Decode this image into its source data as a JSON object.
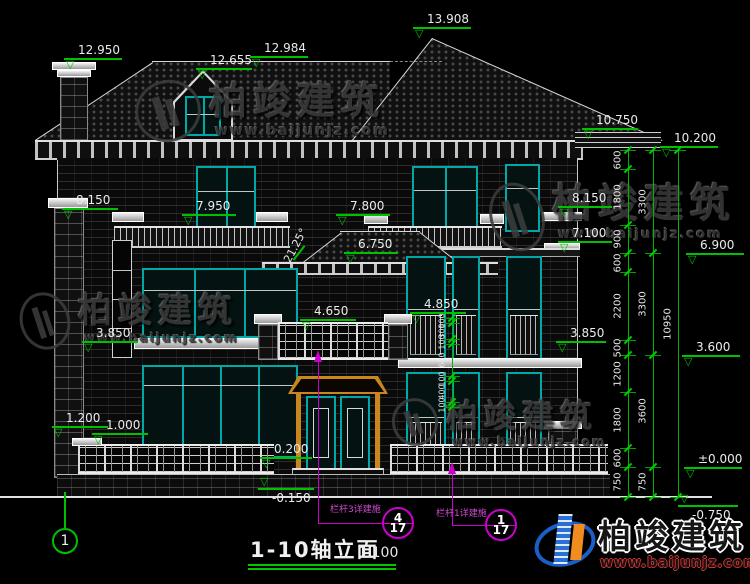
{
  "drawing": {
    "title": "1-10轴立面",
    "scale": "1:100",
    "axis_bubble": "1",
    "roof_angle": "21.25°"
  },
  "colors": {
    "dimension_green": "#00c000",
    "window_teal": "#00a8a8",
    "door_gold": "#c8861e",
    "callout_magenta": "#cc00cc"
  },
  "watermark": {
    "brand": "柏竣建筑",
    "url": "www.baijunjz.com"
  },
  "watermarks": [
    {
      "x": 135,
      "y": 74,
      "cs": 38,
      "us": 14,
      "lw": 66,
      "lh": 62
    },
    {
      "x": 20,
      "y": 286,
      "cs": 34,
      "us": 12,
      "lw": 50,
      "lh": 58
    },
    {
      "x": 490,
      "y": 176,
      "cs": 40,
      "us": 13,
      "lw": 54,
      "lh": 70
    },
    {
      "x": 392,
      "y": 392,
      "cs": 32,
      "us": 12,
      "lw": 46,
      "lh": 48
    }
  ],
  "footer_logo": {
    "brand": "柏竣建筑",
    "url": "www.baijunjz.com"
  },
  "elevation_markers": [
    {
      "v": "12.950",
      "x": 64,
      "y": 58,
      "w": 58
    },
    {
      "v": "12.655",
      "x": 196,
      "y": 68,
      "w": 56
    },
    {
      "v": "12.984",
      "x": 250,
      "y": 56,
      "w": 58
    },
    {
      "v": "13.908",
      "x": 413,
      "y": 27,
      "w": 58
    },
    {
      "v": "10.750",
      "x": 582,
      "y": 128,
      "w": 56
    },
    {
      "v": "10.200",
      "x": 660,
      "y": 146,
      "w": 58
    },
    {
      "v": "8.150",
      "x": 62,
      "y": 208,
      "w": 56
    },
    {
      "v": "7.950",
      "x": 182,
      "y": 214,
      "w": 54
    },
    {
      "v": "7.800",
      "x": 336,
      "y": 214,
      "w": 54
    },
    {
      "v": "6.750",
      "x": 344,
      "y": 252,
      "w": 54
    },
    {
      "v": "8.150",
      "x": 558,
      "y": 206,
      "w": 54
    },
    {
      "v": "7.100",
      "x": 558,
      "y": 241,
      "w": 54
    },
    {
      "v": "6.900",
      "x": 686,
      "y": 253,
      "w": 58
    },
    {
      "v": "4.650",
      "x": 300,
      "y": 319,
      "w": 56
    },
    {
      "v": "4.850",
      "x": 410,
      "y": 312,
      "w": 56
    },
    {
      "v": "3.850",
      "x": 82,
      "y": 341,
      "w": 56
    },
    {
      "v": "3.850",
      "x": 556,
      "y": 341,
      "w": 50
    },
    {
      "v": "3.600",
      "x": 682,
      "y": 355,
      "w": 58
    },
    {
      "v": "1.200",
      "x": 52,
      "y": 426,
      "w": 56
    },
    {
      "v": "1.000",
      "x": 92,
      "y": 433,
      "w": 56
    },
    {
      "v": "0.200",
      "x": 260,
      "y": 457,
      "w": 52
    },
    {
      "v": "-0.150",
      "x": 258,
      "y": 488,
      "w": 56,
      "neg": true
    },
    {
      "v": "±0.000",
      "x": 684,
      "y": 467,
      "w": 58
    },
    {
      "v": "-0.750",
      "x": 678,
      "y": 505,
      "w": 60,
      "neg": true
    }
  ],
  "dimension_chains": [
    {
      "x": 628,
      "boundaries": [
        150,
        169,
        225,
        253,
        272,
        340,
        355,
        392,
        448,
        467,
        497
      ],
      "labels": [
        "600",
        "1800",
        "900",
        "600",
        "2200",
        "500",
        "1200",
        "1800",
        "600",
        "750"
      ]
    },
    {
      "x": 653,
      "boundaries": [
        150,
        253,
        355,
        467,
        497
      ],
      "labels": [
        "3300",
        "3300",
        "3600",
        "750"
      ]
    },
    {
      "x": 678,
      "boundaries": [
        150,
        497
      ],
      "labels": [
        "10950"
      ]
    },
    {
      "x": 452,
      "boundaries": [
        318,
        323,
        339,
        344,
        376,
        381,
        402,
        407
      ],
      "labels": [
        "100",
        "300",
        "100",
        "600",
        "100",
        "400",
        "100"
      ],
      "small": true
    }
  ],
  "callouts": [
    {
      "label": "栏杆3详建施",
      "num": "4",
      "den": "17",
      "label_x": 330,
      "label_y": 506,
      "line_x1": 318,
      "line_x2": 414,
      "line_y": 523,
      "circle_x": 398,
      "circle_y": 523,
      "leader_x": 318,
      "leader_y1": 350,
      "leader_y2": 523
    },
    {
      "label": "栏杆1详建施",
      "num": "1",
      "den": "17",
      "label_x": 436,
      "label_y": 510,
      "line_x1": 452,
      "line_x2": 517,
      "line_y": 525,
      "circle_x": 501,
      "circle_y": 525,
      "leader_x": 452,
      "leader_y1": 462,
      "leader_y2": 525
    }
  ]
}
